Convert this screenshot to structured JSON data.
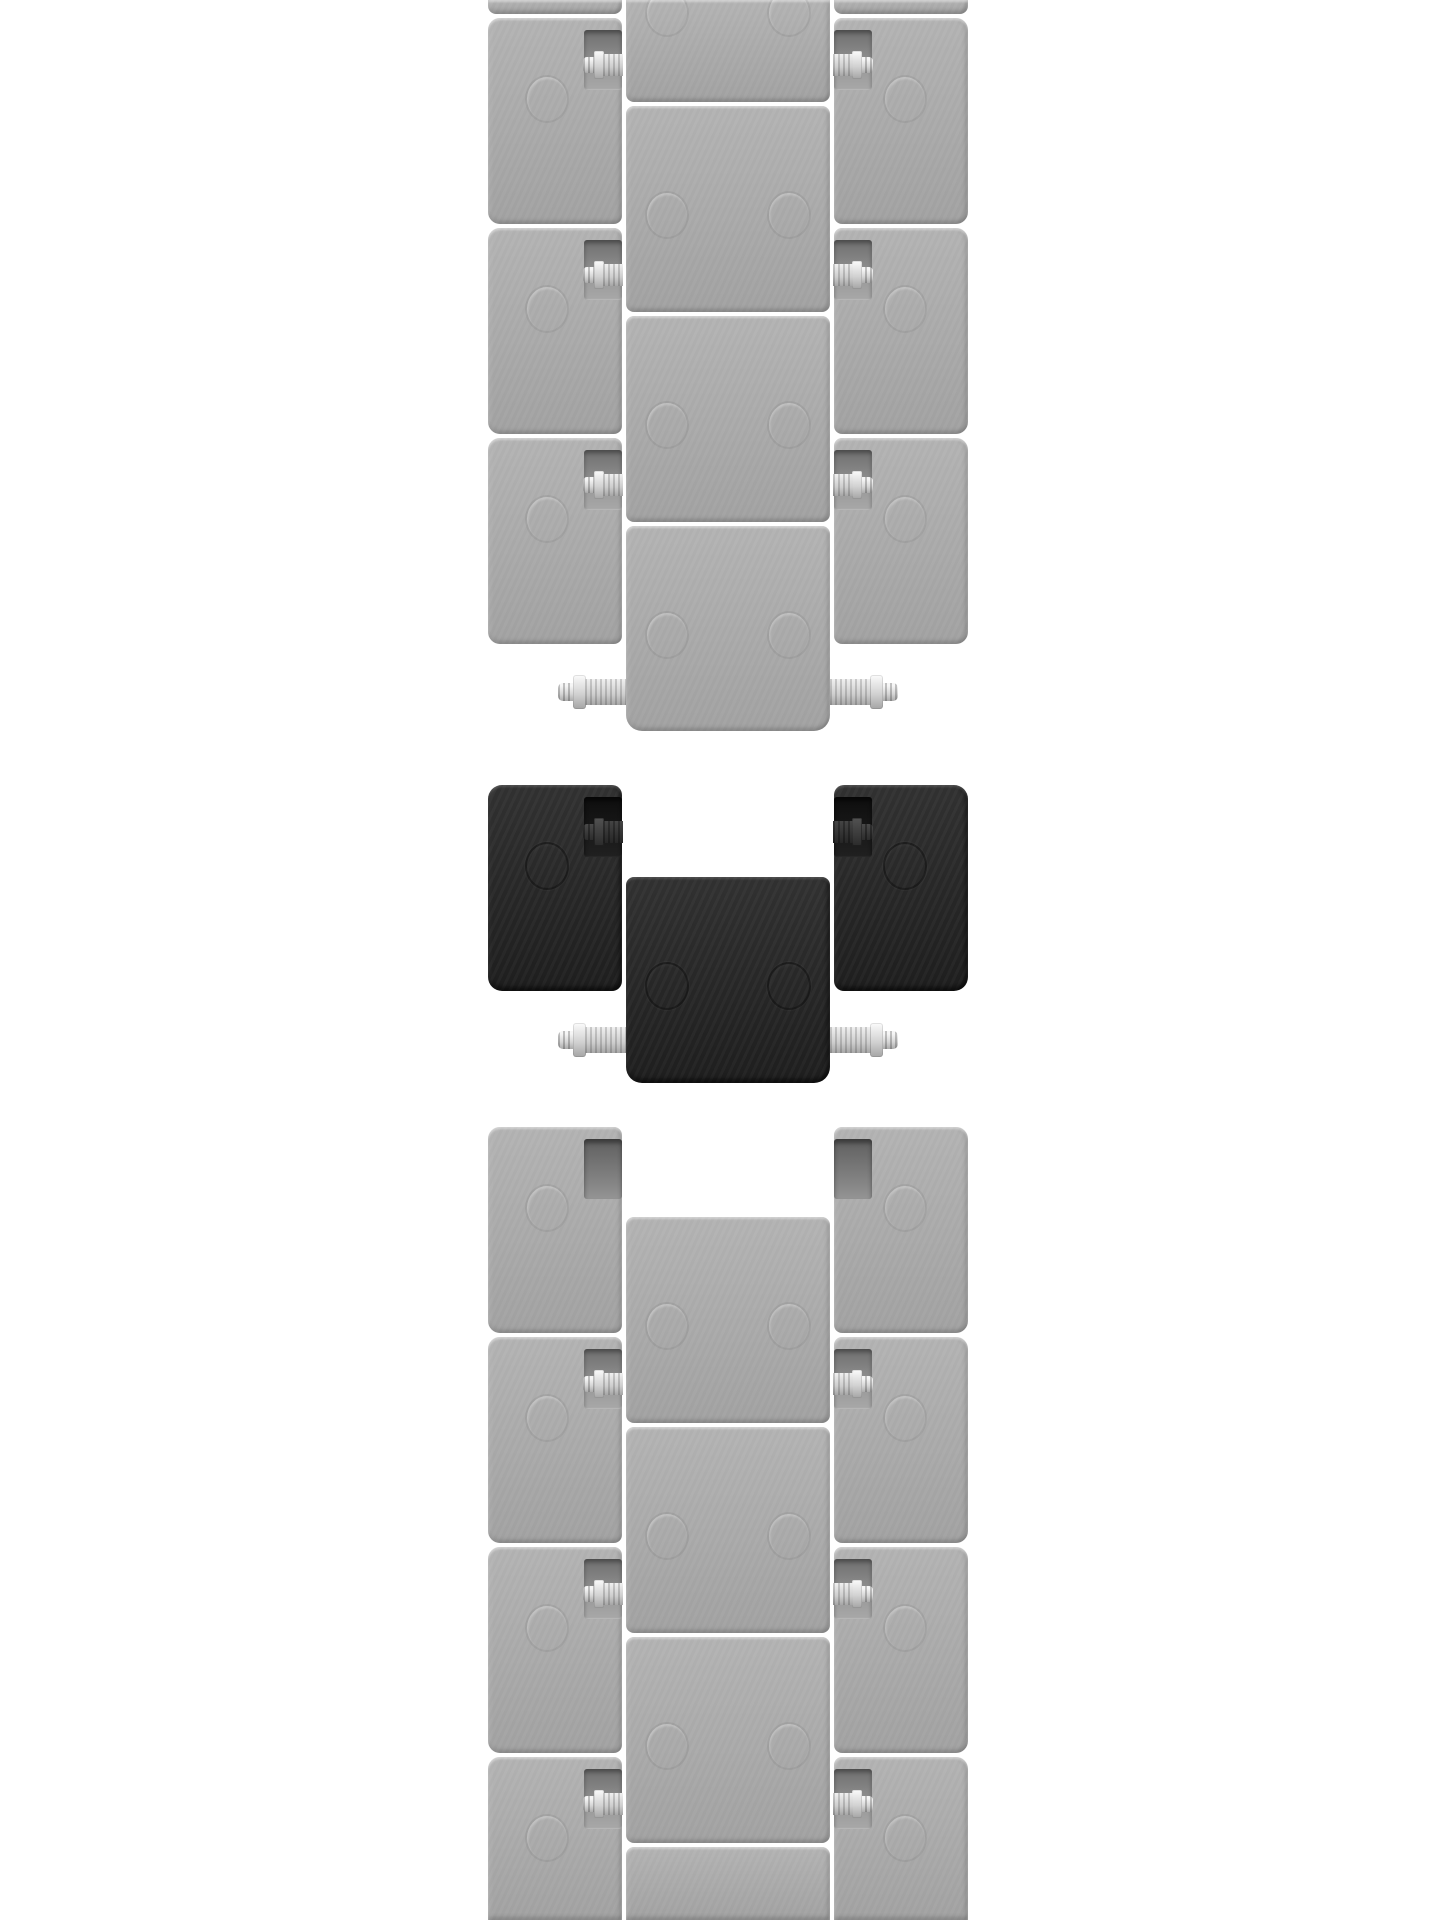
{
  "canvas": {
    "width": 1440,
    "height": 1920,
    "background": "#ffffff"
  },
  "palette": {
    "background": "#ffffff",
    "faded_link_light": "#b5b5b5",
    "faded_link_dark": "#a4a4a4",
    "faded_notch_top": "#6f6f6f",
    "faded_notch_bottom": "#9e9e9e",
    "black_link_light": "#313131",
    "black_link_dark": "#1e1e1e",
    "black_notch_top": "#0e0e0e",
    "black_notch_bottom": "#202020",
    "pin_highlight": "#f6f6f6",
    "pin_mid": "#d6d6d6",
    "pin_shadow": "#ababab",
    "dark_pin_light": "#4a4a4a",
    "dark_pin_dark": "#2c2c2c"
  },
  "sections": [
    {
      "name": "top-bracelet-faded",
      "shade": "gray",
      "pins": [
        {
          "x": 558,
          "cy": 692,
          "dir": "left",
          "variant": "bright"
        },
        {
          "x": 830,
          "cy": 692,
          "dir": "right",
          "variant": "bright"
        }
      ],
      "blocks": [
        {
          "name": "outer-left-sliver",
          "x": 488,
          "y": 0,
          "w": 134,
          "h": 14,
          "radius": "0 0 8px 8px"
        },
        {
          "name": "outer-right-sliver",
          "x": 834,
          "y": 0,
          "w": 134,
          "h": 14,
          "radius": "0 0 8px 8px"
        },
        {
          "name": "center-link-1",
          "x": 626,
          "y": 0,
          "w": 204,
          "h": 102,
          "radius": "0 0 8px 8px",
          "circles": [
            {
              "cx": 666,
              "cy": 12
            },
            {
              "cx": 788,
              "cy": 12
            }
          ]
        },
        {
          "name": "outer-left-row-1",
          "x": 488,
          "y": 18,
          "w": 134,
          "h": 206,
          "radius": "12px 8px 8px 12px",
          "notch": {
            "side": "right",
            "pin": "bright"
          },
          "circles": [
            {
              "cx": 546,
              "cy": 98
            }
          ]
        },
        {
          "name": "outer-right-row-1",
          "x": 834,
          "y": 18,
          "w": 134,
          "h": 206,
          "radius": "8px 12px 12px 8px",
          "notch": {
            "side": "left",
            "pin": "bright"
          },
          "circles": [
            {
              "cx": 904,
              "cy": 98
            }
          ]
        },
        {
          "name": "center-link-2",
          "x": 626,
          "y": 106,
          "w": 204,
          "h": 206,
          "radius": "8px",
          "circles": [
            {
              "cx": 666,
              "cy": 214
            },
            {
              "cx": 788,
              "cy": 214
            }
          ]
        },
        {
          "name": "outer-left-row-2",
          "x": 488,
          "y": 228,
          "w": 134,
          "h": 206,
          "radius": "12px 8px 8px 12px",
          "notch": {
            "side": "right",
            "pin": "bright"
          },
          "circles": [
            {
              "cx": 546,
              "cy": 308
            }
          ]
        },
        {
          "name": "outer-right-row-2",
          "x": 834,
          "y": 228,
          "w": 134,
          "h": 206,
          "radius": "8px 12px 12px 8px",
          "notch": {
            "side": "left",
            "pin": "bright"
          },
          "circles": [
            {
              "cx": 904,
              "cy": 308
            }
          ]
        },
        {
          "name": "center-link-3",
          "x": 626,
          "y": 316,
          "w": 204,
          "h": 206,
          "radius": "8px",
          "circles": [
            {
              "cx": 666,
              "cy": 424
            },
            {
              "cx": 788,
              "cy": 424
            }
          ]
        },
        {
          "name": "outer-left-row-3",
          "x": 488,
          "y": 438,
          "w": 134,
          "h": 206,
          "radius": "12px 8px 8px 12px",
          "notch": {
            "side": "right",
            "pin": "bright"
          },
          "circles": [
            {
              "cx": 546,
              "cy": 518
            }
          ]
        },
        {
          "name": "outer-right-row-3",
          "x": 834,
          "y": 438,
          "w": 134,
          "h": 206,
          "radius": "8px 12px 12px 8px",
          "notch": {
            "side": "left",
            "pin": "bright"
          },
          "circles": [
            {
              "cx": 904,
              "cy": 518
            }
          ]
        },
        {
          "name": "center-link-4",
          "x": 626,
          "y": 526,
          "w": 204,
          "h": 205,
          "radius": "8px 8px 16px 16px",
          "circles": [
            {
              "cx": 666,
              "cy": 634
            },
            {
              "cx": 788,
              "cy": 634
            }
          ]
        }
      ]
    },
    {
      "name": "removable-black-link",
      "shade": "black",
      "pins": [
        {
          "x": 558,
          "cy": 1040,
          "dir": "left",
          "variant": "bright"
        },
        {
          "x": 830,
          "cy": 1040,
          "dir": "right",
          "variant": "bright"
        }
      ],
      "blocks": [
        {
          "name": "black-outer-left",
          "x": 488,
          "y": 785,
          "w": 134,
          "h": 206,
          "radius": "14px 10px 10px 14px",
          "notch": {
            "side": "right",
            "pin": "dark"
          },
          "circles": [
            {
              "cx": 546,
              "cy": 865
            }
          ]
        },
        {
          "name": "black-outer-right",
          "x": 834,
          "y": 785,
          "w": 134,
          "h": 206,
          "radius": "10px 14px 14px 10px",
          "notch": {
            "side": "left",
            "pin": "dark"
          },
          "circles": [
            {
              "cx": 904,
              "cy": 865
            }
          ]
        },
        {
          "name": "black-center-block",
          "x": 626,
          "y": 877,
          "w": 204,
          "h": 206,
          "radius": "8px 8px 16px 16px",
          "circles": [
            {
              "cx": 666,
              "cy": 985
            },
            {
              "cx": 788,
              "cy": 985
            }
          ]
        }
      ]
    },
    {
      "name": "bottom-bracelet-faded",
      "shade": "gray",
      "pins": [],
      "blocks": [
        {
          "name": "outer-left-row-1",
          "x": 488,
          "y": 1127,
          "w": 134,
          "h": 206,
          "radius": "12px 8px 8px 12px",
          "notch": {
            "side": "right",
            "pin": "none"
          },
          "circles": [
            {
              "cx": 546,
              "cy": 1207
            }
          ]
        },
        {
          "name": "outer-right-row-1",
          "x": 834,
          "y": 1127,
          "w": 134,
          "h": 206,
          "radius": "8px 12px 12px 8px",
          "notch": {
            "side": "left",
            "pin": "none"
          },
          "circles": [
            {
              "cx": 904,
              "cy": 1207
            }
          ]
        },
        {
          "name": "center-link-1",
          "x": 626,
          "y": 1217,
          "w": 204,
          "h": 206,
          "radius": "8px",
          "circles": [
            {
              "cx": 666,
              "cy": 1325
            },
            {
              "cx": 788,
              "cy": 1325
            }
          ]
        },
        {
          "name": "outer-left-row-2",
          "x": 488,
          "y": 1337,
          "w": 134,
          "h": 206,
          "radius": "12px 8px 8px 12px",
          "notch": {
            "side": "right",
            "pin": "bright"
          },
          "circles": [
            {
              "cx": 546,
              "cy": 1417
            }
          ]
        },
        {
          "name": "outer-right-row-2",
          "x": 834,
          "y": 1337,
          "w": 134,
          "h": 206,
          "radius": "8px 12px 12px 8px",
          "notch": {
            "side": "left",
            "pin": "bright"
          },
          "circles": [
            {
              "cx": 904,
              "cy": 1417
            }
          ]
        },
        {
          "name": "center-link-2",
          "x": 626,
          "y": 1427,
          "w": 204,
          "h": 206,
          "radius": "8px",
          "circles": [
            {
              "cx": 666,
              "cy": 1535
            },
            {
              "cx": 788,
              "cy": 1535
            }
          ]
        },
        {
          "name": "outer-left-row-3",
          "x": 488,
          "y": 1547,
          "w": 134,
          "h": 206,
          "radius": "12px 8px 8px 12px",
          "notch": {
            "side": "right",
            "pin": "bright"
          },
          "circles": [
            {
              "cx": 546,
              "cy": 1627
            }
          ]
        },
        {
          "name": "outer-right-row-3",
          "x": 834,
          "y": 1547,
          "w": 134,
          "h": 206,
          "radius": "8px 12px 12px 8px",
          "notch": {
            "side": "left",
            "pin": "bright"
          },
          "circles": [
            {
              "cx": 904,
              "cy": 1627
            }
          ]
        },
        {
          "name": "center-link-3",
          "x": 626,
          "y": 1637,
          "w": 204,
          "h": 206,
          "radius": "8px",
          "circles": [
            {
              "cx": 666,
              "cy": 1745
            },
            {
              "cx": 788,
              "cy": 1745
            }
          ]
        },
        {
          "name": "outer-left-row-4",
          "x": 488,
          "y": 1757,
          "w": 134,
          "h": 163,
          "radius": "12px 8px 0 0",
          "notch": {
            "side": "right",
            "pin": "bright"
          },
          "circles": [
            {
              "cx": 546,
              "cy": 1837
            }
          ]
        },
        {
          "name": "outer-right-row-4",
          "x": 834,
          "y": 1757,
          "w": 134,
          "h": 163,
          "radius": "8px 12px 0 0",
          "notch": {
            "side": "left",
            "pin": "bright"
          },
          "circles": [
            {
              "cx": 904,
              "cy": 1837
            }
          ]
        },
        {
          "name": "center-link-4",
          "x": 626,
          "y": 1847,
          "w": 204,
          "h": 73,
          "radius": "8px 8px 0 0"
        }
      ]
    }
  ]
}
